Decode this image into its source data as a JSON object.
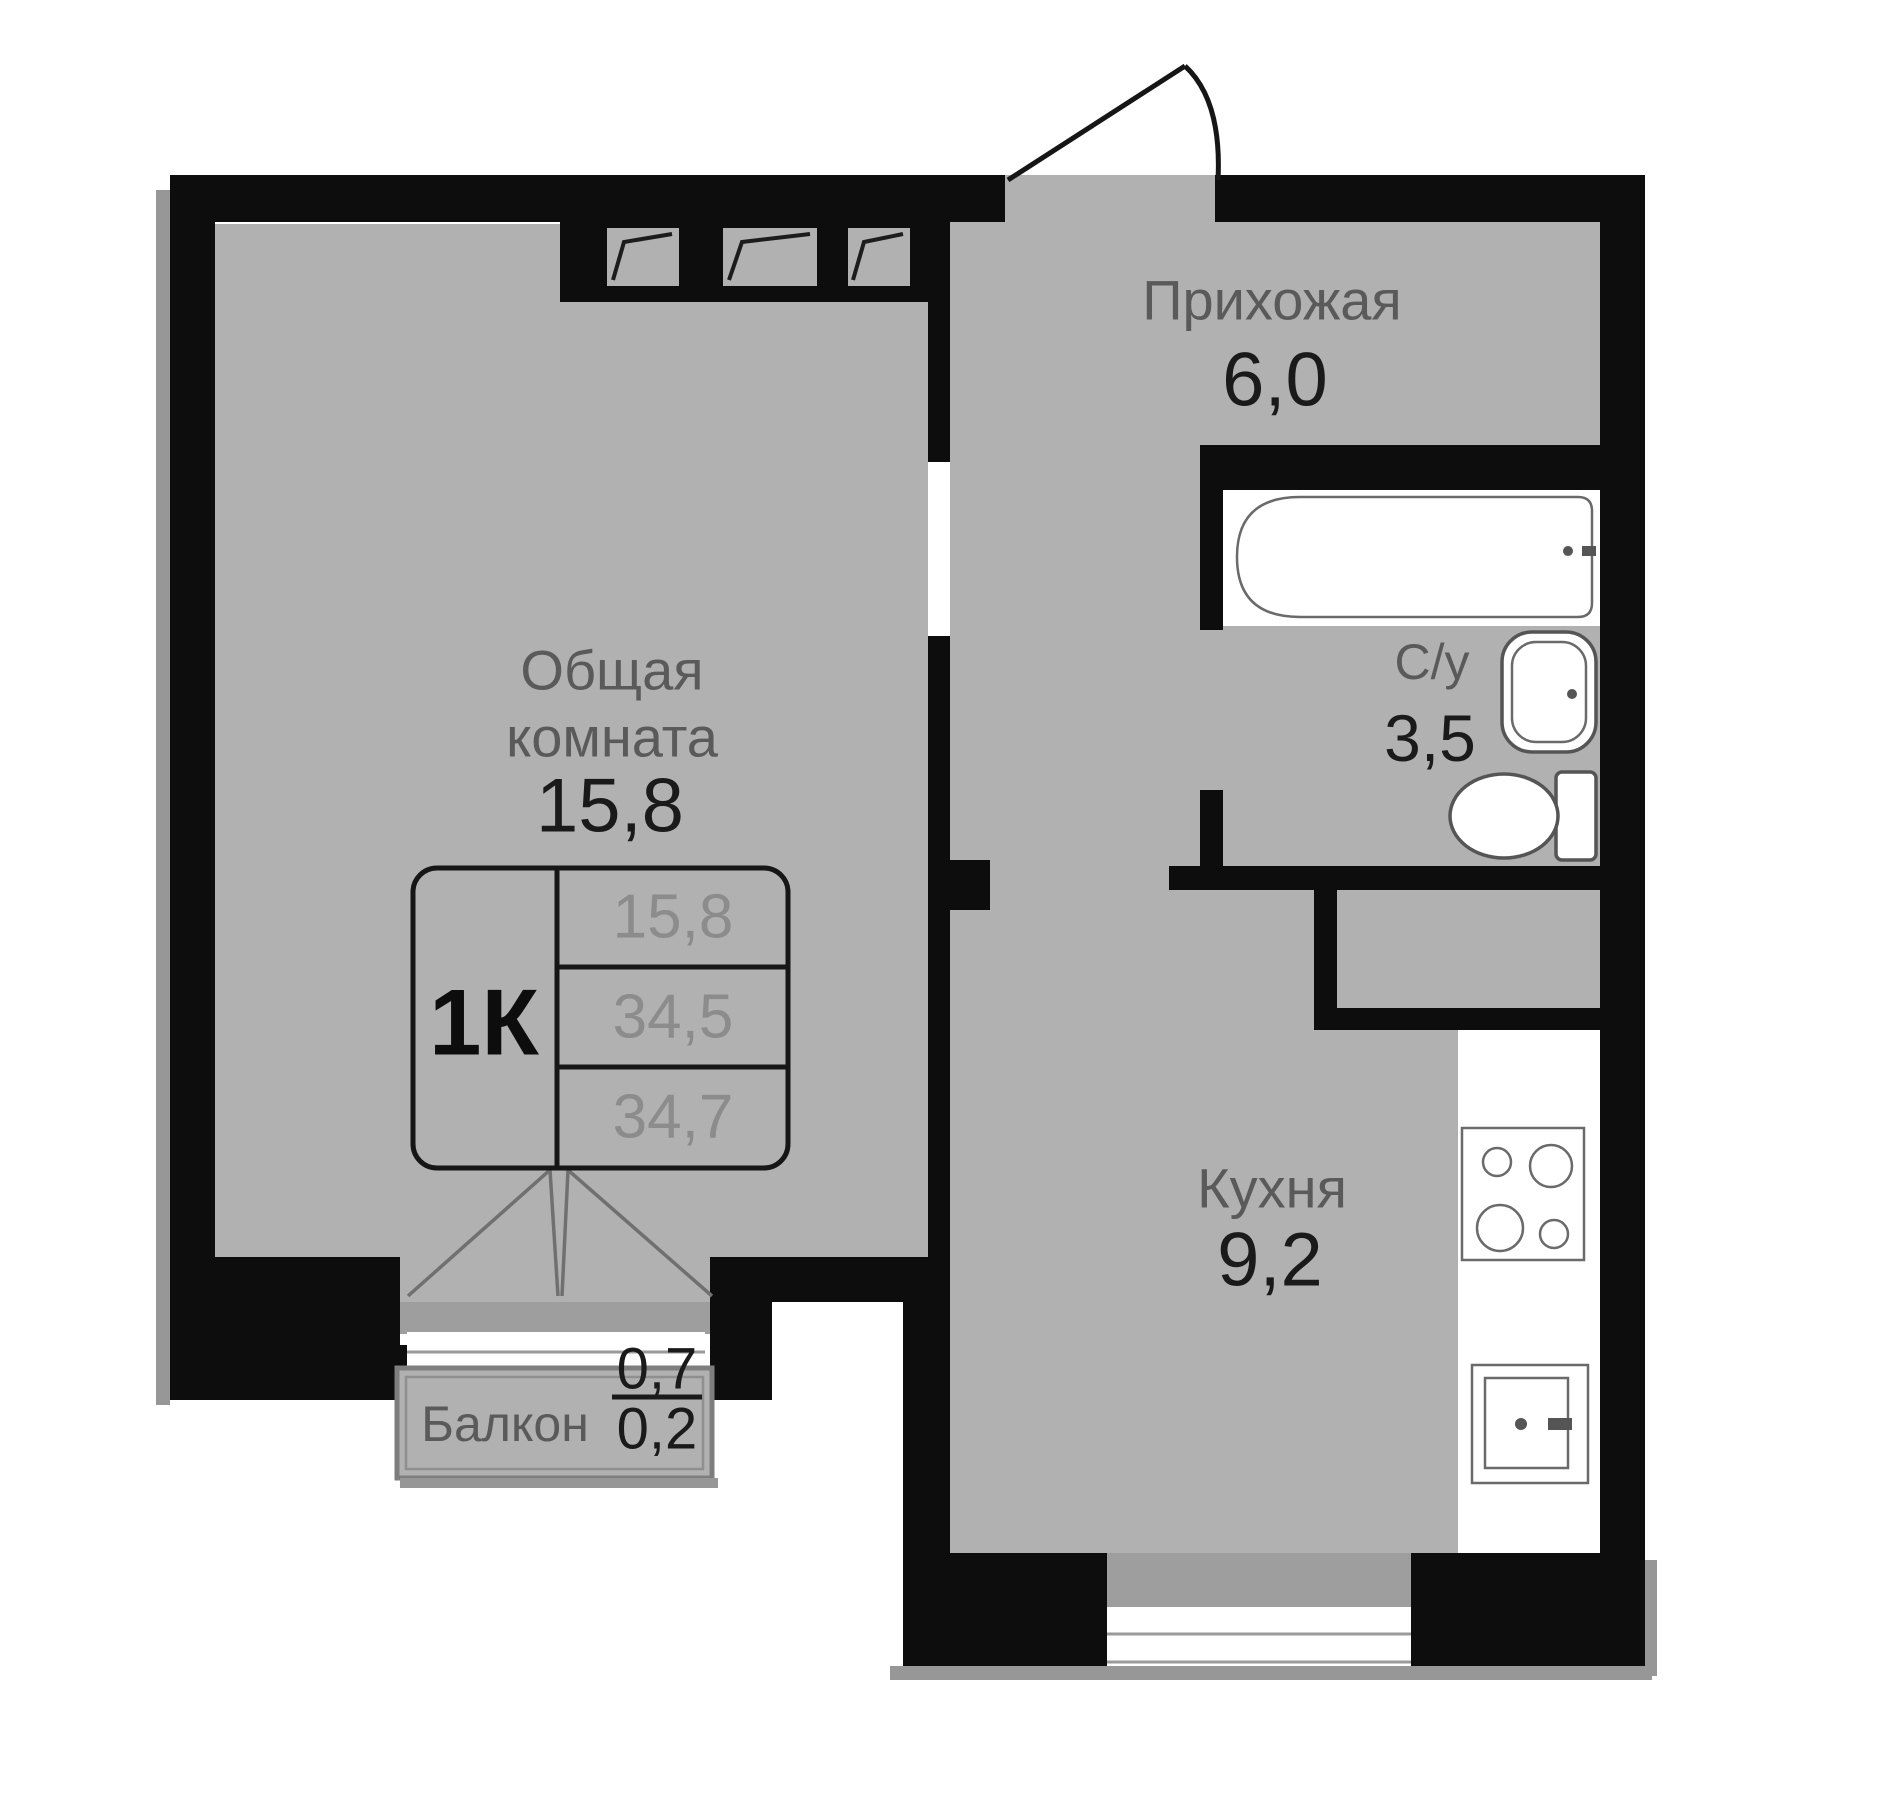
{
  "rooms": {
    "hallway": {
      "name": "Прихожая",
      "area": "6,0"
    },
    "living_room": {
      "name_line1": "Общая",
      "name_line2": "комната",
      "area": "15,8"
    },
    "bathroom": {
      "name": "С/у",
      "area": "3,5"
    },
    "kitchen": {
      "name": "Кухня",
      "area": "9,2"
    },
    "balcony": {
      "name": "Балкон",
      "area_full": "0,7",
      "area_reduced": "0,2"
    }
  },
  "info_table": {
    "apartment_type": "1К",
    "rows": [
      "15,8",
      "34,5",
      "34,7"
    ]
  },
  "icons": {
    "bathtub": "bathtub-icon",
    "washbasin": "washbasin-icon",
    "toilet": "toilet-icon",
    "stove": "stove-burners-icon",
    "kitchen_sink": "kitchen-sink-icon",
    "vent_shaft": "vent-shaft-icon",
    "entrance_door": "entrance-door-swing-icon",
    "balcony_door": "balcony-door-swing-icon"
  },
  "colors": {
    "wall": "#0d0d0d",
    "floor": "#b1b1b1",
    "floor_shaded": "#9e9e9e",
    "fixture_fill": "#ffffff",
    "fixture_stroke": "#555555",
    "room_label": "#5a5a5a",
    "area_number": "#1a1a1a",
    "table_value": "#8c8c8c",
    "shadow": "#979797",
    "background": "#ffffff"
  }
}
